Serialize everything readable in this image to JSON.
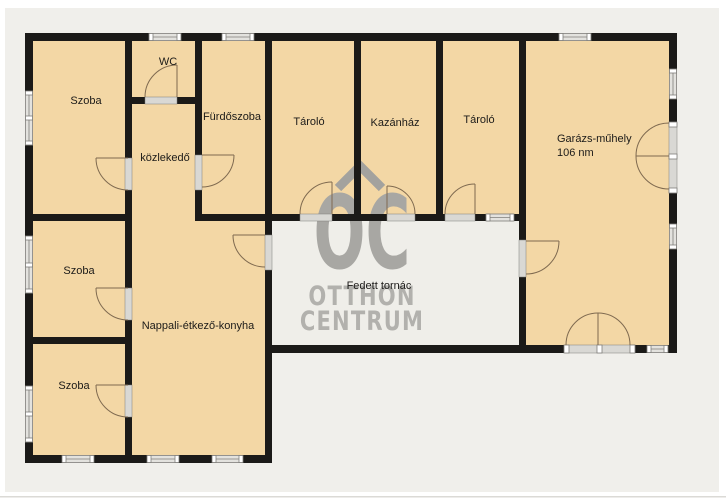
{
  "palette": {
    "frame": "#ffffff",
    "background": "#f0efeb",
    "edge_line": "#dbdad6",
    "floor": "#f3d7a5",
    "porch": "#efeee9",
    "wall": "#1b1a18",
    "window_fill": "#e3e2de",
    "window_cap": "#ffffff",
    "window_edge": "#7f7e7a",
    "door_sill": "#d9d8d4",
    "door_arc": "#7f6a50",
    "label": "#1c1b19",
    "watermark_oc": "#a8a7a3",
    "watermark_text": "#b2b1ad",
    "watermark_roof": "#a3a29e"
  },
  "floorplan": {
    "rooms": [
      {
        "name": "szoba-1",
        "label": "Szoba"
      },
      {
        "name": "wc",
        "label": "WC"
      },
      {
        "name": "furdoszoba",
        "label": "Fürdőszoba"
      },
      {
        "name": "kozlekedo",
        "label": "közlekedő"
      },
      {
        "name": "tarolo-1",
        "label": "Tároló"
      },
      {
        "name": "kazanhaz",
        "label": "Kazánház"
      },
      {
        "name": "tarolo-2",
        "label": "Tároló"
      },
      {
        "name": "garazs-muhely",
        "label": "Garázs-műhely",
        "area": "106 nm"
      },
      {
        "name": "szoba-2",
        "label": "Szoba"
      },
      {
        "name": "szoba-3",
        "label": "Szoba"
      },
      {
        "name": "nappali-etkezo-konyha",
        "label": "Nappali-étkező-konyha"
      },
      {
        "name": "fedett-tornac",
        "label": "Fedett tornác"
      }
    ],
    "watermark": {
      "initials": "OC",
      "brand_line1": "OTTHON",
      "brand_line2": "CENTRUM"
    }
  }
}
